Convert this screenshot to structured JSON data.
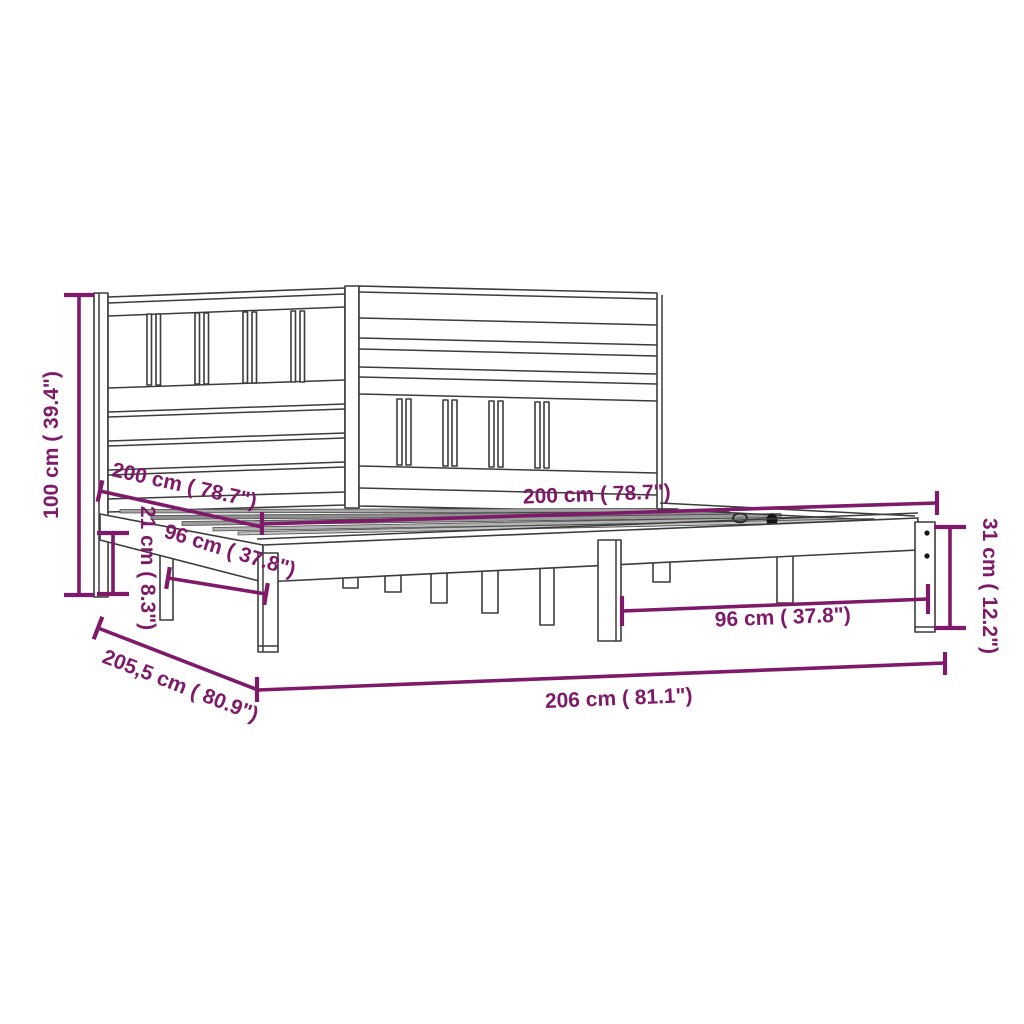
{
  "diagram": {
    "title": "bed-frame-dimension-diagram",
    "product": "wooden bed frame with slatted headboard",
    "background_color": "#ffffff",
    "accent_color": "#7E1A69",
    "line_color": "#3c3c3c",
    "dimensions": [
      {
        "id": "total-height",
        "label": "100 cm ( 39.4\")",
        "orientation": "vertical-left"
      },
      {
        "id": "back-width",
        "label": "200 cm ( 78.7\")",
        "orientation": "diagonal-upper-left"
      },
      {
        "id": "rail-height",
        "label": "21 cm ( 8.3\")",
        "orientation": "vertical-small-left"
      },
      {
        "id": "left-span",
        "label": "96 cm ( 37.8\")",
        "orientation": "diagonal-left"
      },
      {
        "id": "front-width",
        "label": "200 cm ( 78.7\")",
        "orientation": "horizontal-top-right"
      },
      {
        "id": "foot-height",
        "label": "31 cm ( 12.2\")",
        "orientation": "vertical-right"
      },
      {
        "id": "right-span",
        "label": "96 cm ( 37.8\")",
        "orientation": "horizontal-right"
      },
      {
        "id": "depth",
        "label": "205,5 cm ( 80.9\")",
        "orientation": "diagonal-bottom-left"
      },
      {
        "id": "total-length",
        "label": "206 cm ( 81.1\")",
        "orientation": "horizontal-bottom"
      }
    ]
  }
}
